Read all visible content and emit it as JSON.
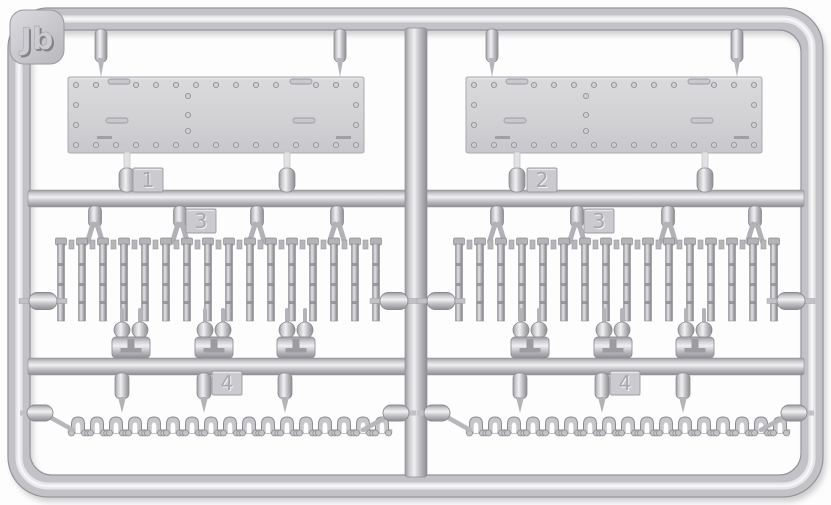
{
  "description": "Light grey injection-molded plastic model sprue, frame with rounded corners, photographed on white",
  "palette": {
    "background": "#fdfdfd",
    "plastic_base": "#c3c3c7",
    "plastic_light": "#f0f0f2",
    "plastic_mid": "#cdcdd1",
    "plastic_dark": "#9a9a9f",
    "plastic_edge": "#8d8d92",
    "panel_fill": "#d3d3d6",
    "rivet_fill": "#cfcfd2",
    "engraved_text": "#a8a8ad",
    "emboss_highlight": "#f1f1f3",
    "label_main": "#cdcdd1",
    "label_shadow": "#83838a"
  },
  "sprue": {
    "label": "Jb",
    "tags": [
      {
        "number": "1"
      },
      {
        "number": "2"
      },
      {
        "number": "3"
      },
      {
        "number": "4"
      }
    ],
    "panels": 2,
    "track_link_rows": 2,
    "track_links_per_row": 16,
    "chain_rows": 2,
    "chain_units_per_row": 17
  },
  "layout": {
    "panel_y": 77,
    "panel_w": 296,
    "panel_h": 76,
    "runner_a_y": 190,
    "runner_b_y": 358,
    "links_top": 238,
    "chain_y": 433,
    "halves": [
      {
        "panel_x": 68,
        "top_gates": [
          101,
          340
        ],
        "bottom_gates": [
          127,
          287
        ],
        "gates3": [
          95,
          180,
          257,
          337
        ],
        "teardrops": [
          131,
          214,
          296
        ],
        "gates4": [
          122,
          204,
          285
        ],
        "links_start": 61,
        "chain_start": 78,
        "caps_mid": [
          43,
          394
        ],
        "caps_chain": [
          40,
          396
        ]
      },
      {
        "panel_x": 466,
        "top_gates": [
          492,
          737
        ],
        "bottom_gates": [
          517,
          705
        ],
        "gates3": [
          497,
          577,
          668,
          755
        ],
        "teardrops": [
          530,
          613,
          695
        ],
        "gates4": [
          520,
          602,
          683
        ],
        "links_start": 459,
        "chain_start": 476,
        "caps_mid": [
          441,
          791
        ],
        "caps_chain": [
          437,
          794
        ]
      }
    ],
    "tag_marks": [
      {
        "i": 0,
        "x": 133,
        "y": 168
      },
      {
        "i": 1,
        "x": 527,
        "y": 168
      },
      {
        "i": 2,
        "x": 186,
        "y": 209
      },
      {
        "i": 2,
        "x": 584,
        "y": 209
      },
      {
        "i": 3,
        "x": 212,
        "y": 371
      },
      {
        "i": 3,
        "x": 610,
        "y": 371
      }
    ]
  }
}
